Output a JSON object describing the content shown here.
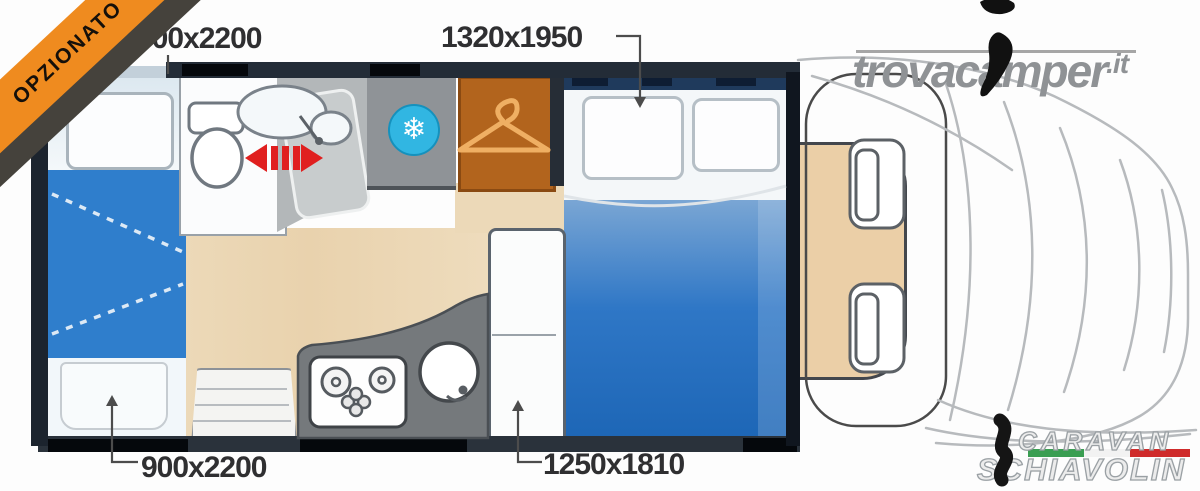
{
  "banner": {
    "label": "OPZIONATO",
    "color": "#ef8b1f",
    "shadow_color": "#45423c",
    "text_color": "#15100a"
  },
  "dimensions": {
    "top_left": "900x2200",
    "top_center": "1320x1950",
    "bottom_left": "900x2200",
    "bottom_center": "1250x1810"
  },
  "watermark": {
    "brand": "trovacamper",
    "tld": ".it"
  },
  "dealer": {
    "line1": "CARAVAN",
    "line2": "SCHIAVOLIN",
    "flag_colors": {
      "green": "#3a9e52",
      "white": "#f2f2f2",
      "red": "#cf2b2b"
    }
  },
  "floorplan": {
    "icons": [
      "snowflake-icon",
      "hanger-icon",
      "sliding-door-arrows-icon"
    ],
    "snowflake_glyph": "❄",
    "areas": [
      "rear-single-bed-top",
      "fold-down-section",
      "rear-single-bed-bottom",
      "bathroom",
      "shower",
      "fridge",
      "wardrobe",
      "double-bed",
      "kitchen-block",
      "sideboard-cabinet",
      "entry-bench",
      "cab-seats",
      "vehicle-front"
    ],
    "colors": {
      "bed_blanket_blue": "#2f77c6",
      "fold_section_blue": "#2f7ecc",
      "floor_wood": "#ecd9b8",
      "fridge_gray": "#8f9397",
      "fridge_badge_cyan": "#31b6e2",
      "wardrobe_brown": "#b2641d",
      "shower_gray": "#b3b7b9",
      "door_arrow_red": "#e01f1f",
      "wall_dark": "#232c37"
    }
  }
}
